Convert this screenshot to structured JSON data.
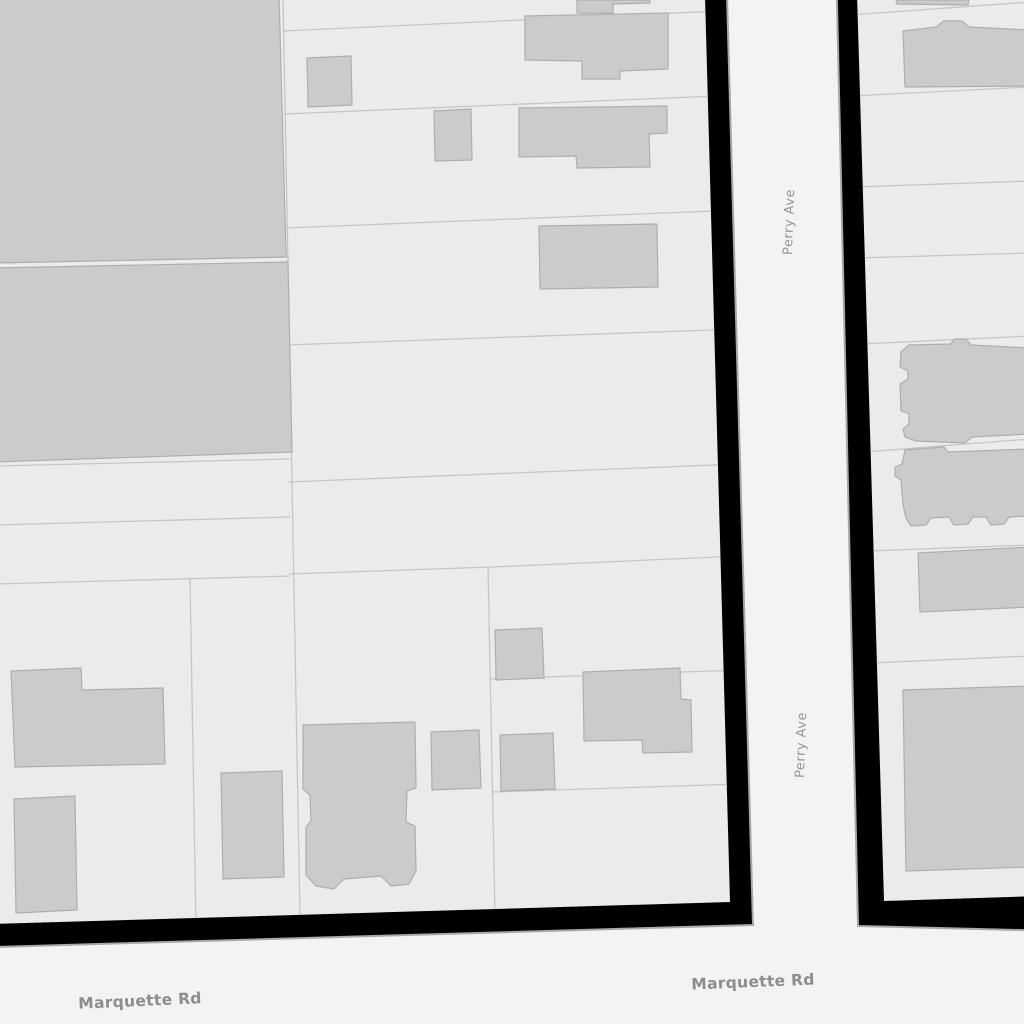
{
  "map": {
    "kind": "street-parcel-map",
    "streets": {
      "perry": {
        "name": "Perry Ave",
        "orientation": "vertical",
        "labels_shown": 2
      },
      "marquette": {
        "name": "Marquette Rd",
        "orientation": "horizontal",
        "labels_shown": 2
      }
    }
  },
  "colors": {
    "street": "#f3f3f3",
    "block": "#ebebeb",
    "building_fill": "#cbcbcb",
    "building_stroke": "#aeaeae",
    "parcel_line": "#c6c6c6",
    "block_casing": "#000000",
    "casing_hairline": "#a8a8a8",
    "horizontal_label": "#8d8d8d",
    "vertical_label": "#969696"
  }
}
